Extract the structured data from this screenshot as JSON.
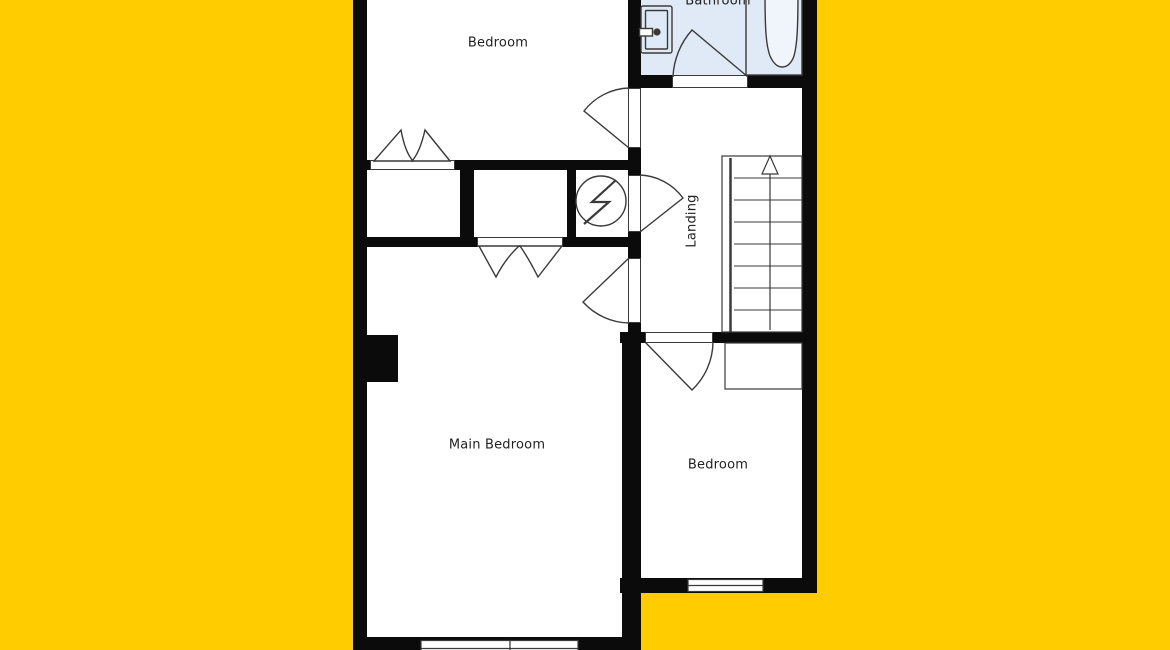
{
  "title": "Floor plan",
  "colors": {
    "background": "#ffcc00",
    "wall": "#0b0b0b",
    "floor": "#ffffff",
    "bathroom_floor": "#e0eaf6",
    "line": "#3a3a3a",
    "label": "#222222"
  },
  "rooms": [
    {
      "id": "bedroom-top",
      "label": "Bedroom"
    },
    {
      "id": "bathroom",
      "label": "Bathroom"
    },
    {
      "id": "landing",
      "label": "Landing"
    },
    {
      "id": "main-bedroom",
      "label": "Main Bedroom"
    },
    {
      "id": "bedroom-bottom",
      "label": "Bedroom"
    }
  ],
  "stairs": {
    "direction": "up",
    "tread_count": 7
  }
}
